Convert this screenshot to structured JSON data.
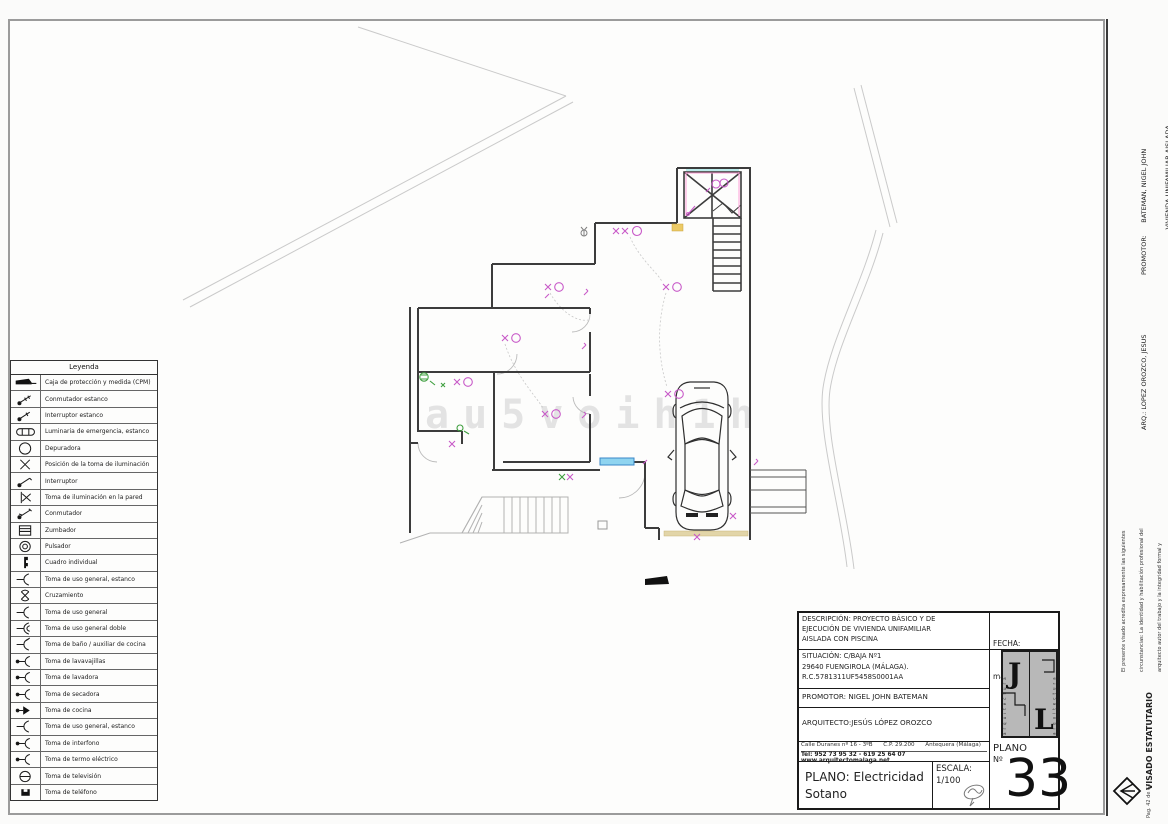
{
  "legend": {
    "title": "Leyenda",
    "items": [
      {
        "symbol": "cpm",
        "label": "Caja de protección y medida (CPM)"
      },
      {
        "symbol": "sw-est",
        "label": "Conmutador estanco"
      },
      {
        "symbol": "int-est",
        "label": "Interruptor estanco"
      },
      {
        "symbol": "emerg",
        "label": "Luminaria de emergencia, estanco"
      },
      {
        "symbol": "dep",
        "label": "Depuradora"
      },
      {
        "symbol": "xpos",
        "label": "Posición de la toma de iluminación"
      },
      {
        "symbol": "int",
        "label": "Interruptor"
      },
      {
        "symbol": "xwall",
        "label": "Toma de iluminación en la pared"
      },
      {
        "symbol": "conm",
        "label": "Conmutador"
      },
      {
        "symbol": "zumb",
        "label": "Zumbador"
      },
      {
        "symbol": "puls",
        "label": "Pulsador"
      },
      {
        "symbol": "cuadro",
        "label": "Cuadro individual"
      },
      {
        "symbol": "toma",
        "label": "Toma de uso general, estanco"
      },
      {
        "symbol": "cruz",
        "label": "Cruzamiento"
      },
      {
        "symbol": "toma",
        "label": "Toma de uso general"
      },
      {
        "symbol": "toma2",
        "label": "Toma de uso general doble"
      },
      {
        "symbol": "toma-b",
        "label": "Toma de baño / auxiliar de cocina"
      },
      {
        "symbol": "toma-dot",
        "label": "Toma de lavavajillas"
      },
      {
        "symbol": "toma-dot",
        "label": "Toma de lavadora"
      },
      {
        "symbol": "toma-dot",
        "label": "Toma de secadora"
      },
      {
        "symbol": "cocina",
        "label": "Toma de cocina"
      },
      {
        "symbol": "toma",
        "label": "Toma de uso general, estanco"
      },
      {
        "symbol": "toma-dot",
        "label": "Toma de interfono"
      },
      {
        "symbol": "toma-dot",
        "label": "Toma de termo eléctrico"
      },
      {
        "symbol": "tv",
        "label": "Toma de televisión"
      },
      {
        "symbol": "tel",
        "label": "Toma de teléfono"
      }
    ]
  },
  "title_block": {
    "descripcion": [
      "DESCRIPCIÓN: PROYECTO BÁSICO Y DE",
      "EJECUCIÓN DE VIVIENDA UNIFAMILIAR",
      "AISLADA CON PISCINA"
    ],
    "fecha_label": "FECHA:",
    "fecha_value": "mayo  2024",
    "situacion": [
      "SITUACIÓN:  C/BAJA Nº1",
      "29640 FUENGIROLA (MÁLAGA).",
      "R.C.5781311UF5458S0001AA"
    ],
    "promotor": "PROMOTOR: NIGEL JOHN BATEMAN",
    "arquitecto": "ARQUITECTO:JESÚS LÓPEZ OROZCO",
    "address_line1": "Calle Duranes nº 16 - 3ºB      C.P. 29.200      Antequera (Málaga)",
    "address_line2": "Tel: 952 73 95 32 - 619 25 64 07 www.arquitectomalaga.net",
    "plano": [
      "PLANO: Electricidad",
      "Sotano"
    ],
    "escala_label": "ESCALA:",
    "escala_value": "1/100",
    "plano_num_label": "PLANO",
    "plano_num_no": "Nº",
    "plano_num": "33",
    "logo_letters": [
      "J",
      "L"
    ],
    "logo_edge_text": "arquitectura"
  },
  "sidebar": {
    "promotor_lines": [
      "PROMOTOR:      BATEMAN, NIGEL JOHN",
      "                      VIVIENDA UNIFAMILIAR AISLADA",
      "                      29640 - FUENGIROLA"
    ],
    "arquitecto_line": "ARQ.: LOPEZ OROZCO, JESUS",
    "visado_note_lines": [
      "El presente visado acredita expresamente las siguientes",
      "circunstancias: La identidad y habilitación profesional del",
      "arquitecto autor del trabajo y la integridad formal y",
      "corrección documental según normativa aplicable."
    ],
    "visado_title": "VISADO ESTATUTARIO",
    "visado_expte": "28/06/2024 - Nº Expte 2024/002448/001",
    "colegio_lines": [
      "COLEGIO OFICIAL DE",
      "ARQUITECTOS DE MÁLAGA"
    ],
    "page_note": "Pag. 42 de 63"
  },
  "watermark": "au5voih1h",
  "colors": {
    "symbol_magenta": "#c85ac8",
    "symbol_green": "#3f9f3f",
    "window_blue": "#8fd4f0",
    "garage_beige": "#e2d5a8",
    "highlight_yellow": "#ecca66"
  }
}
